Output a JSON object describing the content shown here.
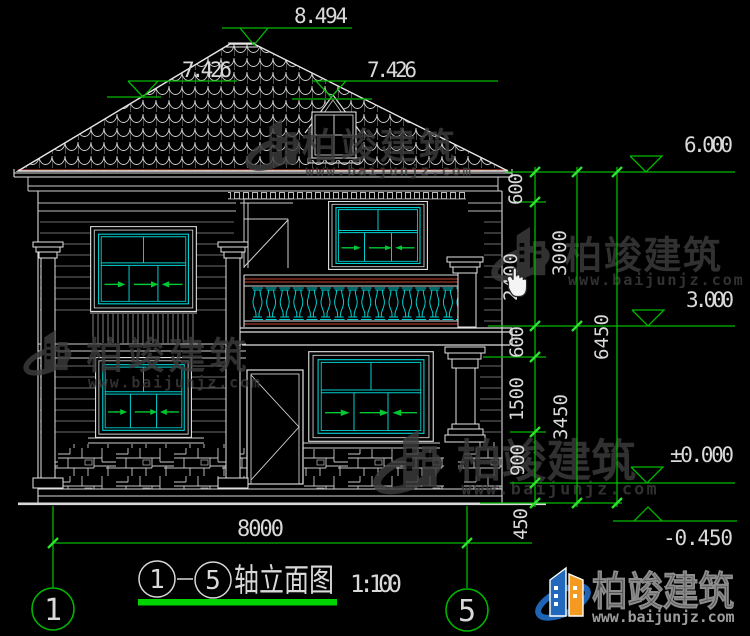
{
  "drawing": {
    "title": {
      "axis_start": "1",
      "axis_end": "5",
      "name": "轴立面图",
      "scale": "1:100"
    },
    "axis_bubbles": {
      "left": "1",
      "right": "5"
    },
    "dims": {
      "ridge": "8.494",
      "slope_left": "7.426",
      "dormer": "7.426",
      "level_eave": "6.000",
      "level_mid": "3.000",
      "level_zero": "±0.000",
      "level_ground": "-0.450",
      "chain1": [
        "600",
        "2400",
        "600",
        "1500",
        "900",
        "450"
      ],
      "chain2": [
        "3000",
        "3450"
      ],
      "chain3": [
        "6450"
      ],
      "total_width": "8000"
    },
    "watermark": {
      "name": "柏竣建筑",
      "url": "www.baijunjz.com"
    },
    "logo": {
      "name": "柏竣建筑",
      "url": "www.baijunjz.com"
    },
    "colors": {
      "dim_green": "#00b800",
      "tick_green": "#2fe22f",
      "window_cyan": "#00cfcf",
      "rail_red": "#a03828",
      "logo_blue": "#1f64b4",
      "logo_orange": "#f49a20"
    }
  }
}
